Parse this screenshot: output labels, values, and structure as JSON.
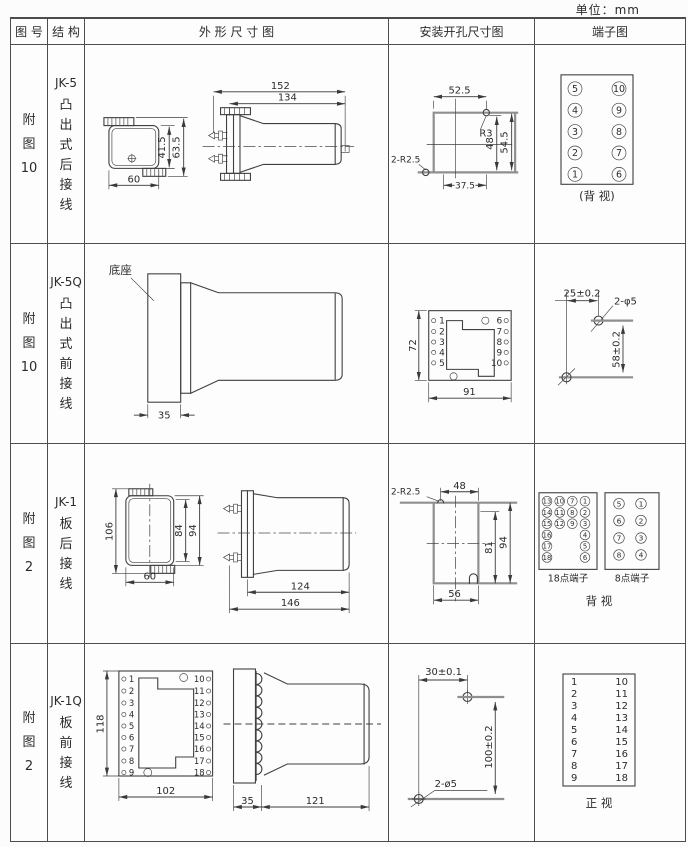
{
  "unit_label": "单位：mm",
  "headers": {
    "fig": "图 号",
    "struct": "结 构",
    "outline": "外 形 尺 寸 图",
    "mount": "安装开孔尺寸图",
    "terminal": "端子图"
  },
  "rows": [
    {
      "fig": [
        "附",
        "图",
        "10"
      ],
      "model": "JK-5",
      "struct": [
        "凸",
        "出",
        "式",
        "后",
        "接",
        "线"
      ],
      "outline": {
        "d152": "152",
        "d134": "134",
        "d41": "41.5",
        "d63": "63.5",
        "d60": "60"
      },
      "mount": {
        "d52": "52.5",
        "r3": "R3",
        "d48": "48",
        "d54": "54.5",
        "d37": "37.5",
        "r25": "2-R2.5"
      },
      "term": {
        "l": [
          "5",
          "4",
          "3",
          "2",
          "1"
        ],
        "r": [
          "10",
          "9",
          "8",
          "7",
          "6"
        ],
        "cap": "(背 视)"
      }
    },
    {
      "fig": [
        "附",
        "图",
        "10"
      ],
      "model": "JK-5Q",
      "struct": [
        "凸",
        "出",
        "式",
        "前",
        "接",
        "线"
      ],
      "outline": {
        "base": "底座",
        "d35": "35"
      },
      "mount": {
        "d72": "72",
        "d91": "91",
        "l": [
          "1",
          "2",
          "3",
          "4",
          "5"
        ],
        "r": [
          "6",
          "7",
          "8",
          "9",
          "10"
        ]
      },
      "term": {
        "d25": "25±0.2",
        "phi": "2-φ5",
        "d58": "58±0.2"
      }
    },
    {
      "fig": [
        "附",
        "图",
        "2"
      ],
      "model": "JK-1",
      "struct": [
        "板",
        "后",
        "接",
        "线"
      ],
      "outline": {
        "d106": "106",
        "d84": "84",
        "d94": "94",
        "d60": "60",
        "d124": "124",
        "d146": "146"
      },
      "mount": {
        "r25": "2-R2.5",
        "d48": "48",
        "d81": "81",
        "d94": "94",
        "d56": "56"
      },
      "term": {
        "c1": [
          "13",
          "14",
          "15",
          "16",
          "17",
          "18"
        ],
        "c2": [
          "10",
          "11",
          "12"
        ],
        "c3": [
          "7",
          "8",
          "9"
        ],
        "c4": [
          "1",
          "2",
          "3",
          "4",
          "5",
          "6"
        ],
        "cap18": "18点端子",
        "l8": [
          "5",
          "6",
          "7",
          "8"
        ],
        "r8": [
          "1",
          "2",
          "3",
          "4"
        ],
        "cap8": "8点端子",
        "cap": "背  视"
      }
    },
    {
      "fig": [
        "附",
        "图",
        "2"
      ],
      "model": "JK-1Q",
      "struct": [
        "板",
        "前",
        "接",
        "线"
      ],
      "outline": {
        "d118": "118",
        "d102": "102",
        "d35": "35",
        "d121": "121",
        "l": [
          "1",
          "2",
          "3",
          "4",
          "5",
          "6",
          "7",
          "8",
          "9"
        ],
        "r": [
          "10",
          "11",
          "12",
          "13",
          "14",
          "15",
          "16",
          "17",
          "18"
        ]
      },
      "mount": {
        "d30": "30±0.1",
        "d100": "100±0.2",
        "phi": "2-ø5"
      },
      "term": {
        "l": [
          "1",
          "2",
          "3",
          "4",
          "5",
          "6",
          "7",
          "8",
          "9"
        ],
        "r": [
          "10",
          "11",
          "12",
          "13",
          "14",
          "15",
          "16",
          "17",
          "18"
        ],
        "cap": "正  视"
      }
    }
  ]
}
